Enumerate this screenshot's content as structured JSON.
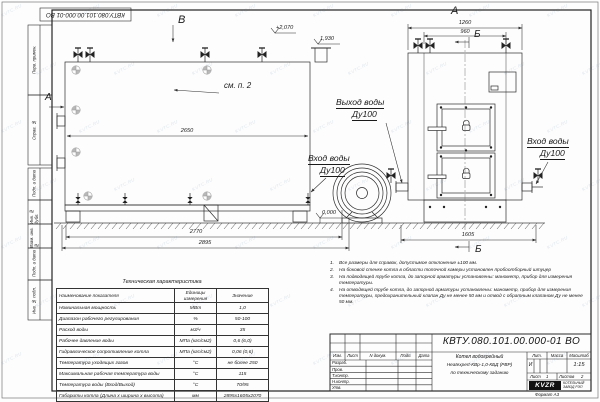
{
  "doc_number": "КВТУ.080.101.00.000-01  ВО",
  "watermark": "KVTC.RU",
  "frame": {
    "side_labels": [
      "Перв. примен.",
      "Справ. №",
      "Подп. и дата",
      "Инв. № дубл.",
      "Взам. инв. №",
      "Подп. и дата",
      "Инв. № подл."
    ],
    "format": "Формат  А3"
  },
  "labels": {
    "view_side": "В",
    "view_side_arrow": "А",
    "view_front": "А",
    "section_top": "Б",
    "section_bottom": "Б",
    "callout": "см. п. 2",
    "outlet_l1": "Выход воды",
    "outlet_l2": "Ду100",
    "inlet_left_l1": "Вход воды",
    "inlet_left_l2": "Ду100",
    "inlet_right_l1": "Вход воды",
    "inlet_right_l2": "Ду100"
  },
  "dims": {
    "d2650": "2650",
    "d2770": "2770",
    "d2895": "2895",
    "d1260": "1260",
    "d960": "960",
    "d1605": "1605",
    "elev_top": "+2,070",
    "elev_mid": "1,930",
    "elev_zero": "0,000"
  },
  "table": {
    "title": "Техническая характеристика",
    "headers": [
      "Наименование показателя",
      "Единицы измерения",
      "Значение"
    ],
    "rows": [
      [
        "Номинальная мощность",
        "МВт",
        "1,0"
      ],
      [
        "Диапазон рабочего регулирования",
        "%",
        "50-100"
      ],
      [
        "Расход воды",
        "м3/ч",
        "35"
      ],
      [
        "Рабочее давление воды",
        "МПа (кгс/см2)",
        "0,6 (6,0)"
      ],
      [
        "Гидравлическое сопротивление котла",
        "МПа (кгс/см2)",
        "0,06 (0,6)"
      ],
      [
        "Температура уходящих газов",
        "°С",
        "не более 250"
      ],
      [
        "Максимальная рабочая температура воды",
        "°С",
        "115"
      ],
      [
        "Температура воды (Вход/Выход)",
        "°С",
        "70/95"
      ],
      [
        "Габариты котла (Длина х ширина х высота)",
        "мм",
        "2895х1605х2070"
      ]
    ]
  },
  "notes": [
    {
      "n": "1.",
      "t": "Все размеры для справок, допустимое отклонение ±100 мм."
    },
    {
      "n": "2.",
      "t": "На боковой стенке котла в области топочной камеры установлен пробоотборный штуцер"
    },
    {
      "n": "3.",
      "t": "На подводящей трубе котла, до запорной арматуры установлены: манометр, прибор для измерения температуры."
    },
    {
      "n": "4.",
      "t": "На отводящей трубе котла, до запорной арматуры установлены: манометр, прибор для измерения температуры, предохранительный клапан Ду не менее 50 мм и отвод с обратным клапаном Ду не менее 50 мм."
    }
  ],
  "titleblock": {
    "header_cols": [
      "Изм.",
      "Лист",
      "N докум.",
      "Подп.",
      "Дата"
    ],
    "org_rows": [
      "Разраб.",
      "Пров.",
      "Т.контр.",
      "Н.контр.",
      "Утв."
    ],
    "lit_label": "Лит.",
    "mass_label": "Масса",
    "scale_label": "Масштаб",
    "lit": "И",
    "scale": "1:15",
    "sheet_label": "Лист",
    "sheet": "1",
    "sheets_label": "Листов",
    "sheets": "2",
    "name1": "Котел водогрейный",
    "name2": "Heatexpert-КВр-1,0-КБД (РВР)",
    "name3": "по техническому заданию",
    "logo": "KVZR",
    "logo_sub1": "КОТЕЛЬНЫЙ",
    "logo_sub2": "ЗАВОД РЭП"
  }
}
